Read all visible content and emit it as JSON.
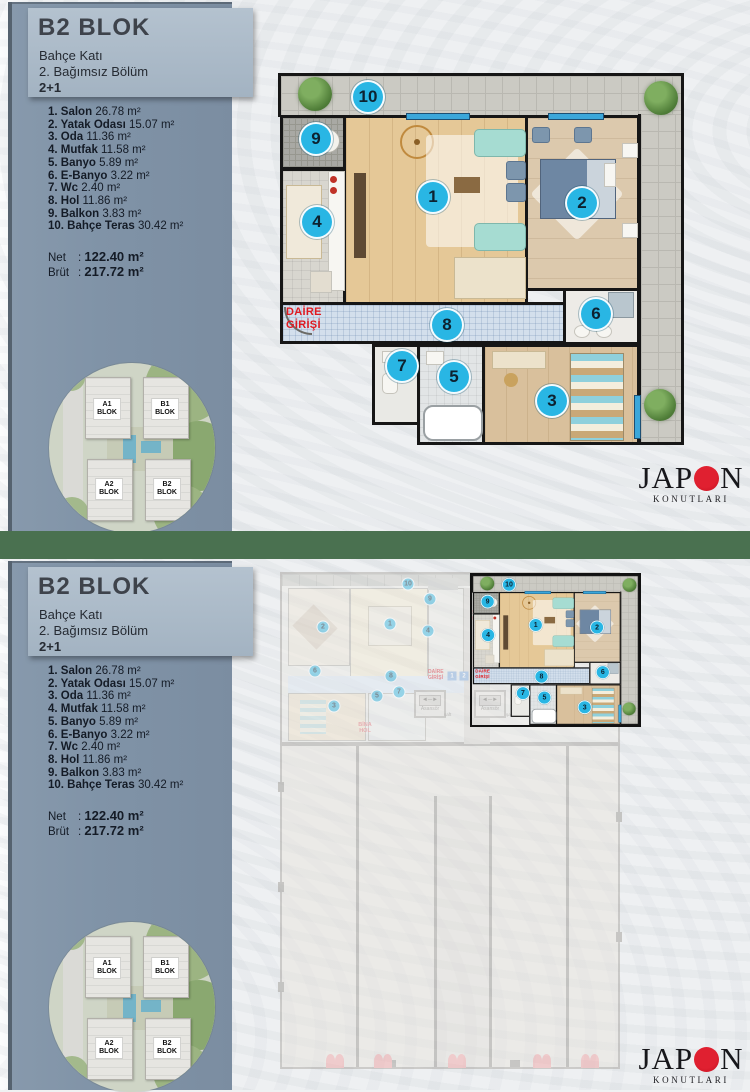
{
  "colors": {
    "divider_green": "#4a7150",
    "accent_cyan": "#29b6e4",
    "entry_red": "#e01920",
    "logo_red": "#d41524",
    "sidebar_blue": "#8093a7"
  },
  "sidebar": {
    "title": "B2 BLOK",
    "subtitle1": "Bahçe Katı",
    "subtitle2": "2. Bağımsız Bölüm",
    "subtitle3": "2+1",
    "rooms": [
      {
        "name": "1. Salon",
        "area": "26.78 m²"
      },
      {
        "name": "2. Yatak Odası",
        "area": "15.07 m²"
      },
      {
        "name": "3. Oda",
        "area": "11.36 m²"
      },
      {
        "name": "4. Mutfak",
        "area": "11.58 m²"
      },
      {
        "name": "5. Banyo",
        "area": "5.89 m²"
      },
      {
        "name": "6. E-Banyo",
        "area": "3.22 m²"
      },
      {
        "name": "7. Wc",
        "area": "2.40 m²"
      },
      {
        "name": "8. Hol",
        "area": "11.86 m²"
      },
      {
        "name": "9. Balkon",
        "area": "3.83 m²"
      },
      {
        "name": "10. Bahçe Teras",
        "area": "30.42 m²"
      }
    ],
    "totals": [
      {
        "label": "Net",
        "value": "122.40 m²"
      },
      {
        "label": "Brüt",
        "value": "217.72 m²"
      }
    ]
  },
  "site_plan": {
    "blocks": [
      {
        "l1": "A1",
        "l2": "BLOK",
        "x": 58,
        "y": 46
      },
      {
        "l1": "B1",
        "l2": "BLOK",
        "x": 116,
        "y": 46
      },
      {
        "l1": "A2",
        "l2": "BLOK",
        "x": 60,
        "y": 126
      },
      {
        "l1": "B2",
        "l2": "BLOK",
        "x": 118,
        "y": 126
      }
    ]
  },
  "plan": {
    "entry_line1": "DAİRE",
    "entry_line2": "GİRİŞİ",
    "circles": [
      {
        "n": "1",
        "x": 155,
        "y": 124
      },
      {
        "n": "2",
        "x": 304,
        "y": 130
      },
      {
        "n": "3",
        "x": 274,
        "y": 328
      },
      {
        "n": "4",
        "x": 39,
        "y": 149
      },
      {
        "n": "5",
        "x": 176,
        "y": 304
      },
      {
        "n": "6",
        "x": 318,
        "y": 241
      },
      {
        "n": "7",
        "x": 124,
        "y": 293
      },
      {
        "n": "8",
        "x": 169,
        "y": 252
      },
      {
        "n": "9",
        "x": 38,
        "y": 66
      },
      {
        "n": "10",
        "x": 90,
        "y": 24
      }
    ]
  },
  "floor": {
    "bina_hol_l1": "BİNA",
    "bina_hol_l2": "HOL",
    "asansor": "Asansör",
    "saft": "şaft",
    "markers": [
      {
        "n": "1",
        "x": 174,
        "y": 104
      },
      {
        "n": "2",
        "x": 186,
        "y": 104
      }
    ],
    "circles": [
      {
        "n": "10",
        "x": 130,
        "y": 12
      },
      {
        "n": "9",
        "x": 152,
        "y": 27
      },
      {
        "n": "2",
        "x": 45,
        "y": 55
      },
      {
        "n": "1",
        "x": 112,
        "y": 52
      },
      {
        "n": "4",
        "x": 150,
        "y": 59
      },
      {
        "n": "6",
        "x": 37,
        "y": 99
      },
      {
        "n": "8",
        "x": 113,
        "y": 104
      },
      {
        "n": "7",
        "x": 121,
        "y": 120
      },
      {
        "n": "5",
        "x": 99,
        "y": 124
      },
      {
        "n": "3",
        "x": 56,
        "y": 134
      }
    ]
  },
  "logo": {
    "part1": "JAP",
    "part2": "N",
    "subtitle": "KONUTLARI"
  }
}
